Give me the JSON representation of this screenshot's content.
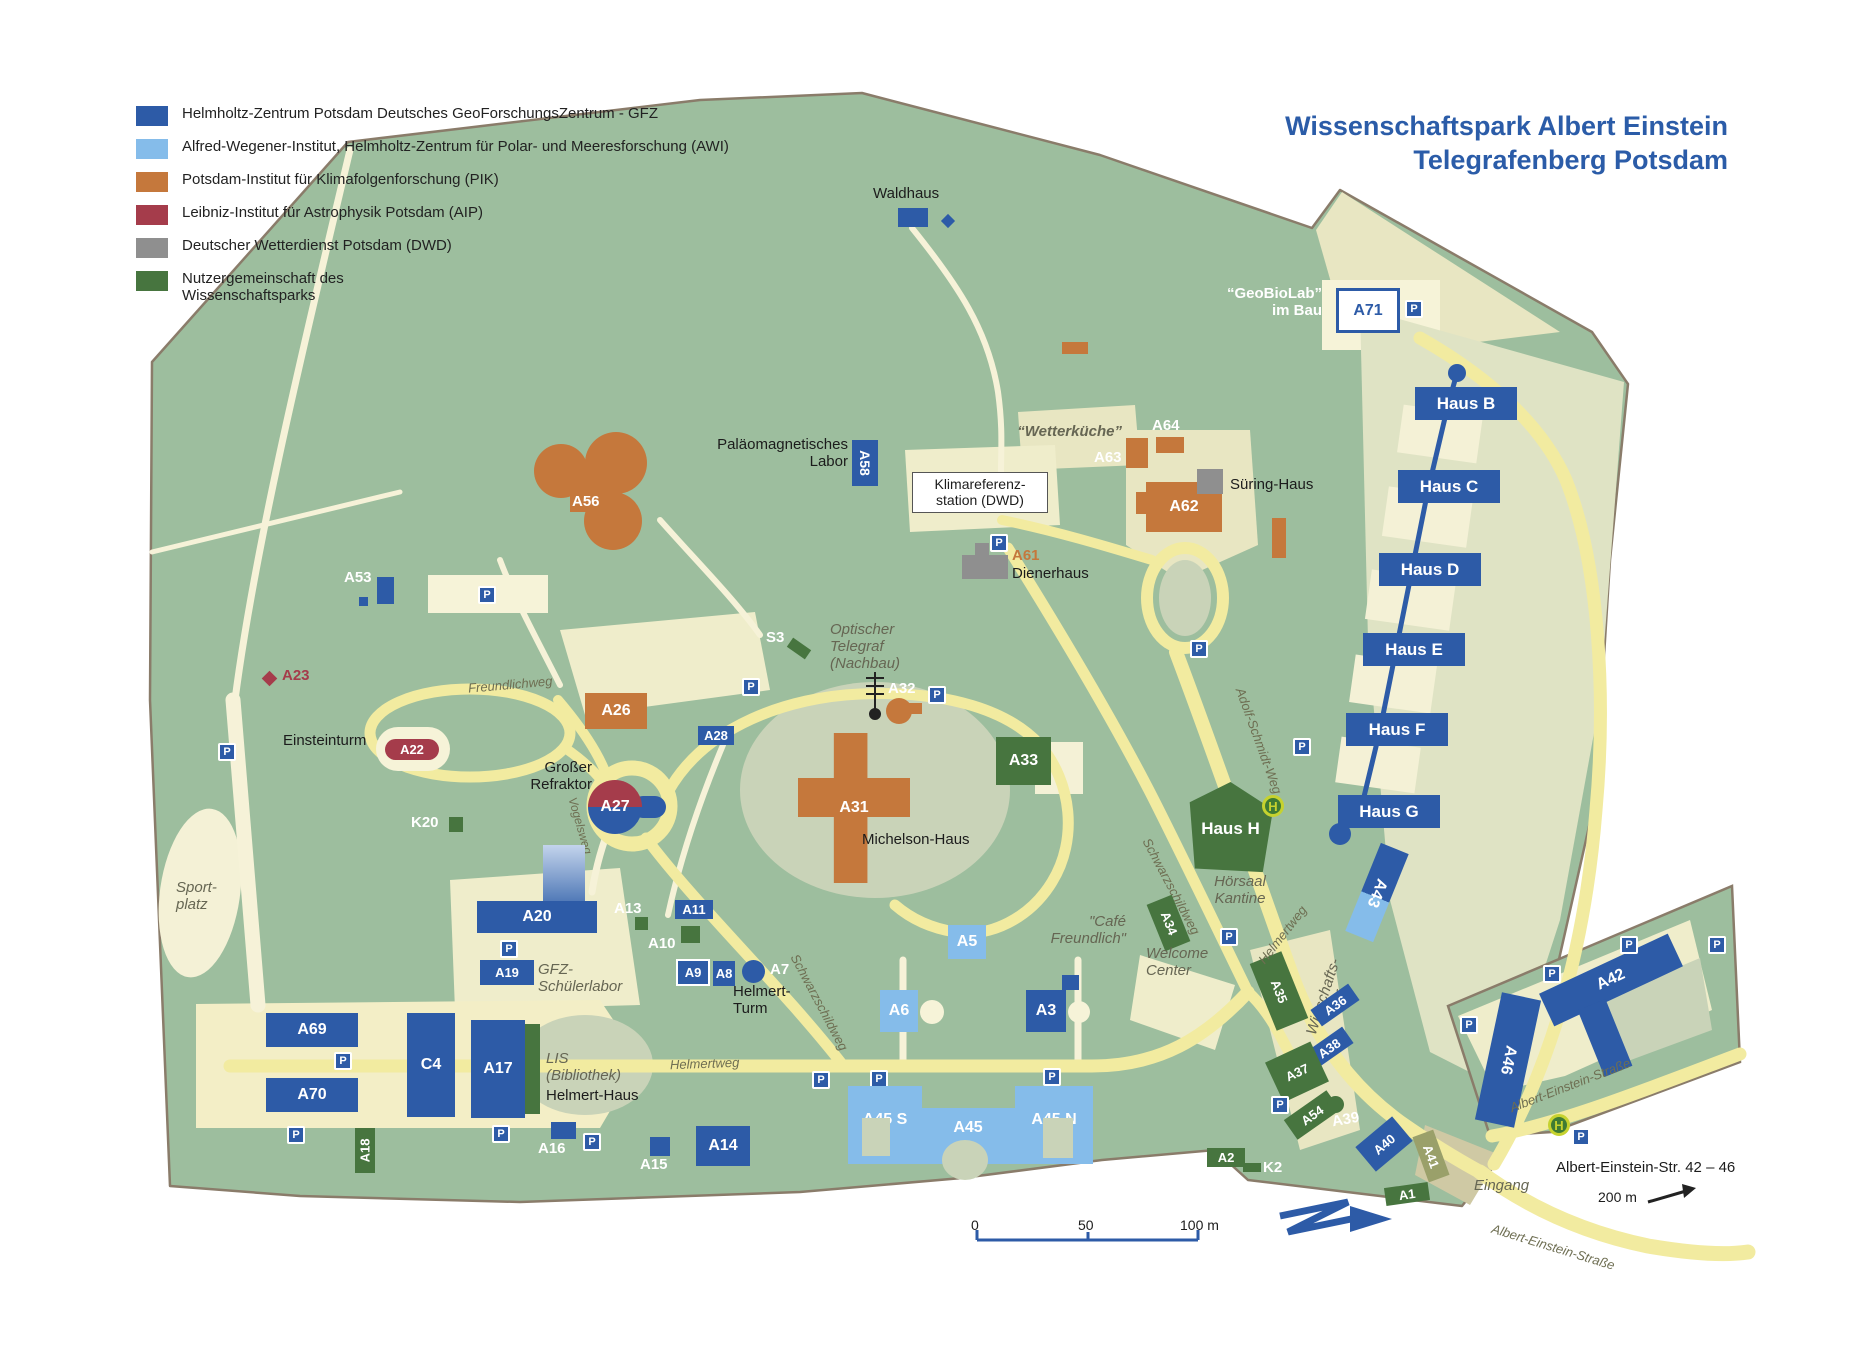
{
  "title": {
    "line1": "Wissenschaftspark Albert Einstein",
    "line2": "Telegrafenberg Potsdam"
  },
  "legend": {
    "items": [
      {
        "label": "Helmholtz-Zentrum Potsdam Deutsches GeoForschungsZentrum - GFZ",
        "color": "#2D5BA7"
      },
      {
        "label": "Alfred-Wegener-Institut, Helmholtz-Zentrum für Polar- und Meeresforschung (AWI)",
        "color": "#85BCEA"
      },
      {
        "label": "Potsdam-Institut für Klimafolgenforschung (PIK)",
        "color": "#C5783C"
      },
      {
        "label": "Leibniz-Institut für Astrophysik Potsdam (AIP)",
        "color": "#A53C4B"
      },
      {
        "label": "Deutscher Wetterdienst Potsdam (DWD)",
        "color": "#8F8F8F"
      },
      {
        "label": "Nutzergemeinschaft des Wissenschaftsparks",
        "color": "#47753F"
      }
    ]
  },
  "buildings": {
    "a71": "A71",
    "haus_b": "Haus B",
    "haus_c": "Haus C",
    "haus_d": "Haus D",
    "haus_e": "Haus E",
    "haus_f": "Haus F",
    "haus_g": "Haus G",
    "haus_h": "Haus H",
    "a43": "A43",
    "a62": "A62",
    "a64": "A64",
    "a63": "A63",
    "a61": "A61",
    "a58": "A58",
    "a56": "A56",
    "a53": "A53",
    "a32": "A32",
    "s3": "S3",
    "a28": "A28",
    "a26": "A26",
    "a22": "A22",
    "a23": "A23",
    "a27": "A27",
    "k20": "K20",
    "a31": "A31",
    "a33": "A33",
    "a34": "A34",
    "a20": "A20",
    "a19": "A19",
    "a13": "A13",
    "a11": "A11",
    "a10": "A10",
    "a9": "A9",
    "a8": "A8",
    "a7": "A7",
    "a5": "A5",
    "a6": "A6",
    "a3": "A3",
    "a69": "A69",
    "a70": "A70",
    "c4": "C4",
    "a17": "A17",
    "a18": "A18",
    "a16": "A16",
    "a15": "A15",
    "a14": "A14",
    "a45s": "A45 S",
    "a45": "A45",
    "a45n": "A45 N",
    "a35": "A35",
    "a36": "A36",
    "a37": "A37",
    "a38": "A38",
    "a54": "A54",
    "a39": "A39",
    "a40": "A40",
    "a41": "A41",
    "a1": "A1",
    "a2": "A2",
    "k2": "K2",
    "a46": "A46",
    "a42": "A42"
  },
  "labels": {
    "waldhaus": "Waldhaus",
    "geobiolab1": "“GeoBioLab”",
    "geobiolab2": "im Bau",
    "palaeo1": "Paläomagnetisches",
    "palaeo2": "Labor",
    "klima1": "Klimareferenz-",
    "klima2": "station (DWD)",
    "wetterkueche": "“Wetterküche”",
    "suering": "Süring-Haus",
    "dienerhaus": "Dienerhaus",
    "optischer1": "Optischer",
    "optischer2": "Telegraf",
    "optischer3": "(Nachbau)",
    "einsteinturm": "Einsteinturm",
    "grosser1": "Großer",
    "grosser2": "Refraktor",
    "michelson": "Michelson-Haus",
    "sport1": "Sport-",
    "sport2": "platz",
    "gfz_schueler1": "GFZ-",
    "gfz_schueler2": "Schülerlabor",
    "helmert_turm1": "Helmert-",
    "helmert_turm2": "Turm",
    "lis1": "LIS",
    "lis2": "(Bibliothek)",
    "helmert_haus": "Helmert-Haus",
    "hoersaal1": "Hörsaal",
    "hoersaal2": "Kantine",
    "cafe1": "\"Café",
    "cafe2": "Freundlich\"",
    "welcome1": "Welcome",
    "welcome2": "Center",
    "wirtschaft1": "Wirtschafts-",
    "wirtschaft2": "hof",
    "eingang": "Eingang",
    "einstein_caption": "Albert-Einstein-Str. 42 – 46",
    "dist200": "200 m"
  },
  "roads": {
    "freundlichweg": "Freundlichweg",
    "vogelsweg": "Vogelsweg",
    "schwarzschildweg": "Schwarzschildweg",
    "helmertweg": "Helmertweg",
    "adolf_schmidt": "Adolf-Schmidt-Weg",
    "albert_einstein": "Albert-Einstein-Straße"
  },
  "scale": {
    "t0": "0",
    "t50": "50",
    "t100": "100 m"
  },
  "icons": {
    "parking": "P",
    "bus_stop": "H"
  }
}
